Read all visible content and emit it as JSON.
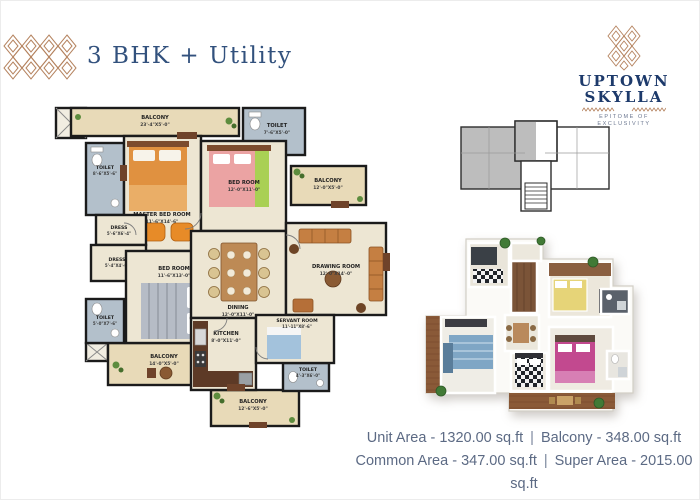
{
  "header": {
    "title": "3 BHK + Utility"
  },
  "logo": {
    "line1": "UPTOWN",
    "line2": "SKYLLA",
    "tagline": "EPITOME OF EXCLUSIVITY"
  },
  "plan2d": {
    "rooms": {
      "balcony_top": {
        "name": "BALCONY",
        "dims": "23'-4\"X5'-0\""
      },
      "toilet_top_right": {
        "name": "TOILET",
        "dims": "7'-6\"X5'-0\""
      },
      "toilet_left": {
        "name": "TOILET",
        "dims": "8'-6\"X5'-6\""
      },
      "master_bed": {
        "name": "MASTER BED ROOM",
        "dims": "11'-6\"X14'-6\""
      },
      "bed_top": {
        "name": "BED ROOM",
        "dims": "12'-0\"X11'-0\""
      },
      "balcony_right": {
        "name": "BALCONY",
        "dims": "12'-0\"X5'-0\""
      },
      "dress_upper": {
        "name": "DRESS",
        "dims": "5'-6\"X6'-4\""
      },
      "dress_lower": {
        "name": "DRESS",
        "dims": "5'-4\"X4'-6\""
      },
      "bed_lower": {
        "name": "BED ROOM",
        "dims": "11'-6\"X13'-0\""
      },
      "dining": {
        "name": "DINING",
        "dims": "12'-0\"X11'-0\""
      },
      "drawing": {
        "name": "DRAWING ROOM",
        "dims": "12'-0\"X14'-0\""
      },
      "toilet_bottom_left": {
        "name": "TOILET",
        "dims": "5'-0\"X7'-6\""
      },
      "balcony_bottom_left": {
        "name": "BALCONY",
        "dims": "14'-0\"X5'-0\""
      },
      "kitchen": {
        "name": "KITCHEN",
        "dims": "8'-0\"X11'-0\""
      },
      "servant": {
        "name": "SERVANT ROOM",
        "dims": "11'-11\"X8'-6\""
      },
      "toilet_servant": {
        "name": "TOILET",
        "dims": "4'-3\"X6'-0\""
      },
      "balcony_bottom": {
        "name": "BALCONY",
        "dims": "12'-6\"X5'-0\""
      }
    }
  },
  "areas": {
    "unit": "Unit Area - 1320.00 sq.ft",
    "balcony": "Balcony - 348.00 sq.ft",
    "common": "Common Area - 347.00 sq.ft",
    "super": "Super Area - 2015.00 sq.ft",
    "separator": "|"
  },
  "colors": {
    "navy": "#32517d",
    "copper": "#b5835f",
    "wall": "#1b1b1b",
    "floor": "#ede6d3",
    "balcony_floor": "#e8dab8",
    "toilet_floor": "#b3c0cb"
  }
}
